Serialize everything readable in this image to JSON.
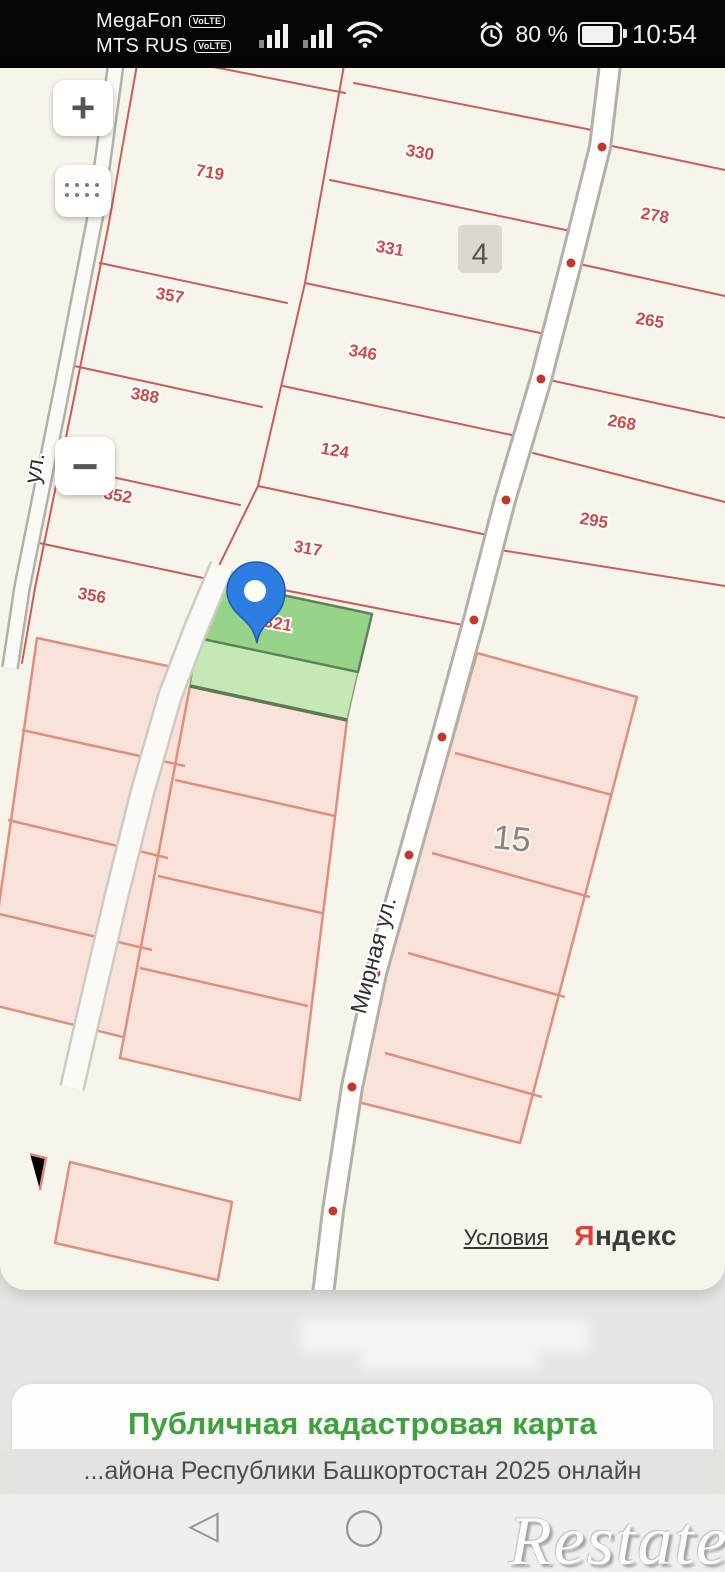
{
  "status_bar": {
    "carrier_primary": "MegaFon",
    "carrier_secondary": "MTS RUS",
    "volte_badge": "VoLTE",
    "battery_percent": "80 %",
    "time": "10:54"
  },
  "map": {
    "zoom_in_label": "+",
    "zoom_out_label": "−",
    "parcels": [
      {
        "label": "719"
      },
      {
        "label": "330"
      },
      {
        "label": "331"
      },
      {
        "label": "278"
      },
      {
        "label": "357"
      },
      {
        "label": "346"
      },
      {
        "label": "265"
      },
      {
        "label": "388"
      },
      {
        "label": "124"
      },
      {
        "label": "268"
      },
      {
        "label": "352"
      },
      {
        "label": "295"
      },
      {
        "label": "317"
      },
      {
        "label": "356"
      },
      {
        "label": "321"
      }
    ],
    "area_marker": "4",
    "block_label": "15",
    "street_main": "Мирная ул.",
    "street_left": "ул.",
    "attribution_terms": "Условия",
    "brand_initial": "Я",
    "brand_rest": "ндекс"
  },
  "footer": {
    "heading": "Публичная кадастровая карта",
    "ticker": "...айона Республики Башкортостан 2025 онлайн",
    "nav_back_icon": "◁",
    "nav_home_icon": "◯",
    "watermark": "Restate"
  }
}
